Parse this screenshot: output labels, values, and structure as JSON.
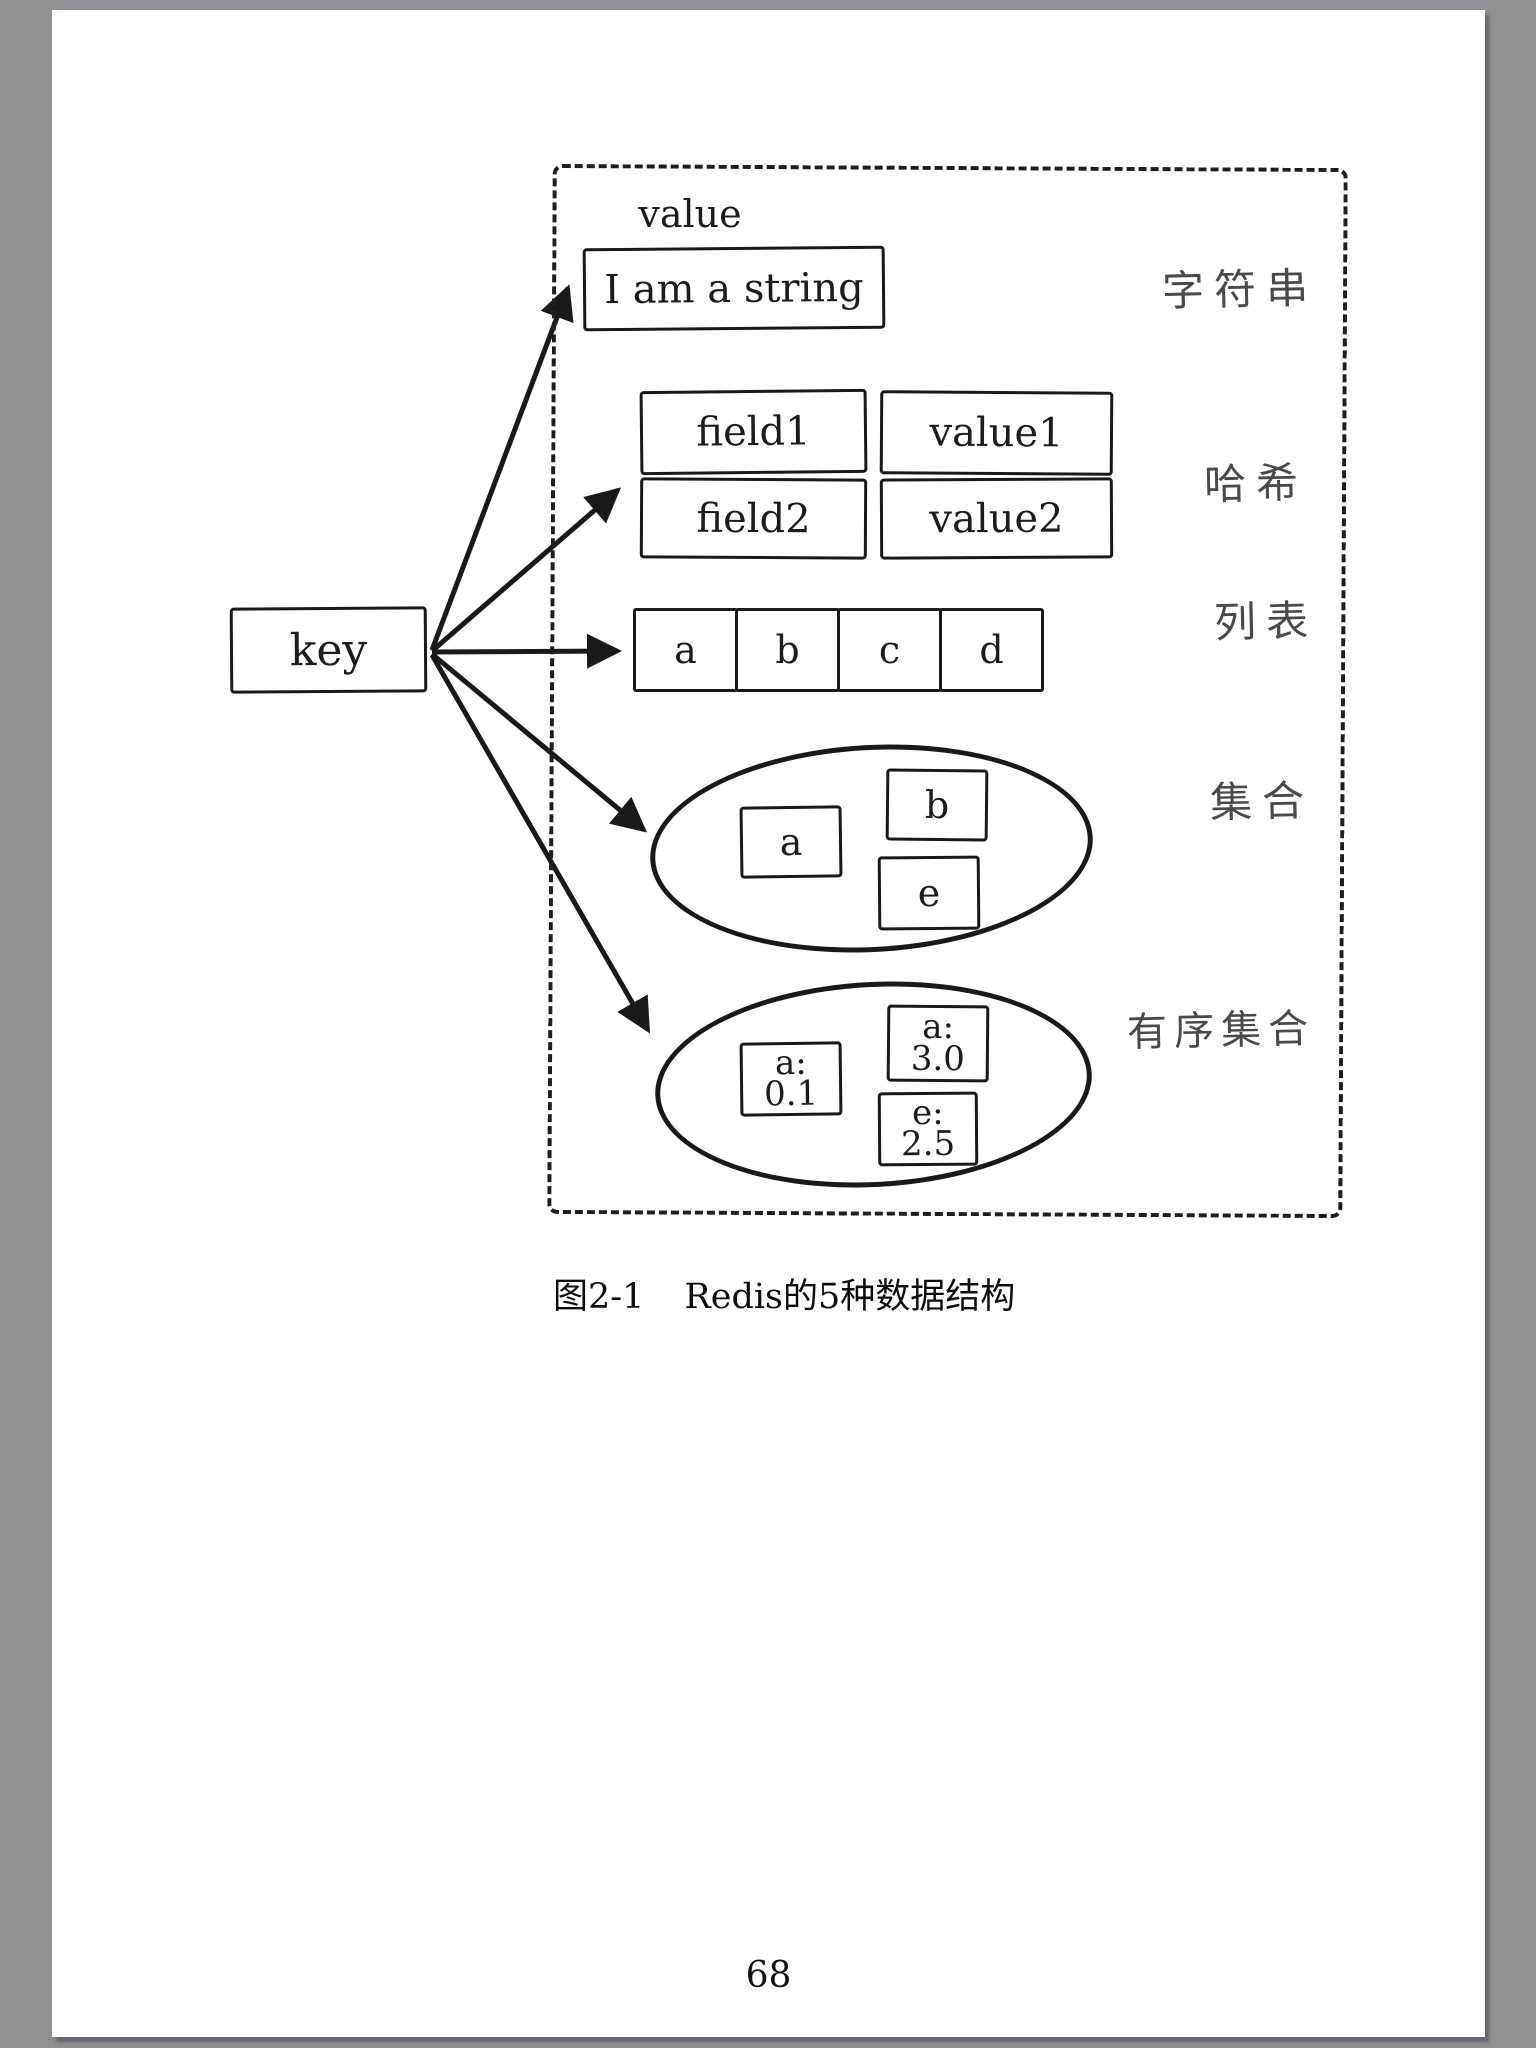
{
  "page": {
    "number": "68",
    "caption": {
      "figure_label": "图2-1",
      "figure_title": "Redis的5种数据结构"
    }
  },
  "diagram": {
    "key_label": "key",
    "value_label": "value",
    "string": {
      "text": "I am a string",
      "category": "字符串"
    },
    "hash": {
      "category": "哈希",
      "rows": [
        {
          "field": "field1",
          "value": "value1"
        },
        {
          "field": "field2",
          "value": "value2"
        }
      ]
    },
    "list": {
      "category": "列表",
      "items": [
        "a",
        "b",
        "c",
        "d"
      ]
    },
    "set": {
      "category": "集合",
      "items": [
        "a",
        "b",
        "e"
      ]
    },
    "zset": {
      "category": "有序集合",
      "items": [
        {
          "member": "a:",
          "score": "0.1"
        },
        {
          "member": "a:",
          "score": "3.0"
        },
        {
          "member": "e:",
          "score": "2.5"
        }
      ]
    },
    "colors": {
      "ink": "#1c1c1c",
      "handwriting": "#4a4a4a",
      "paper": "#ffffff",
      "surround": "#8e8e94"
    }
  }
}
